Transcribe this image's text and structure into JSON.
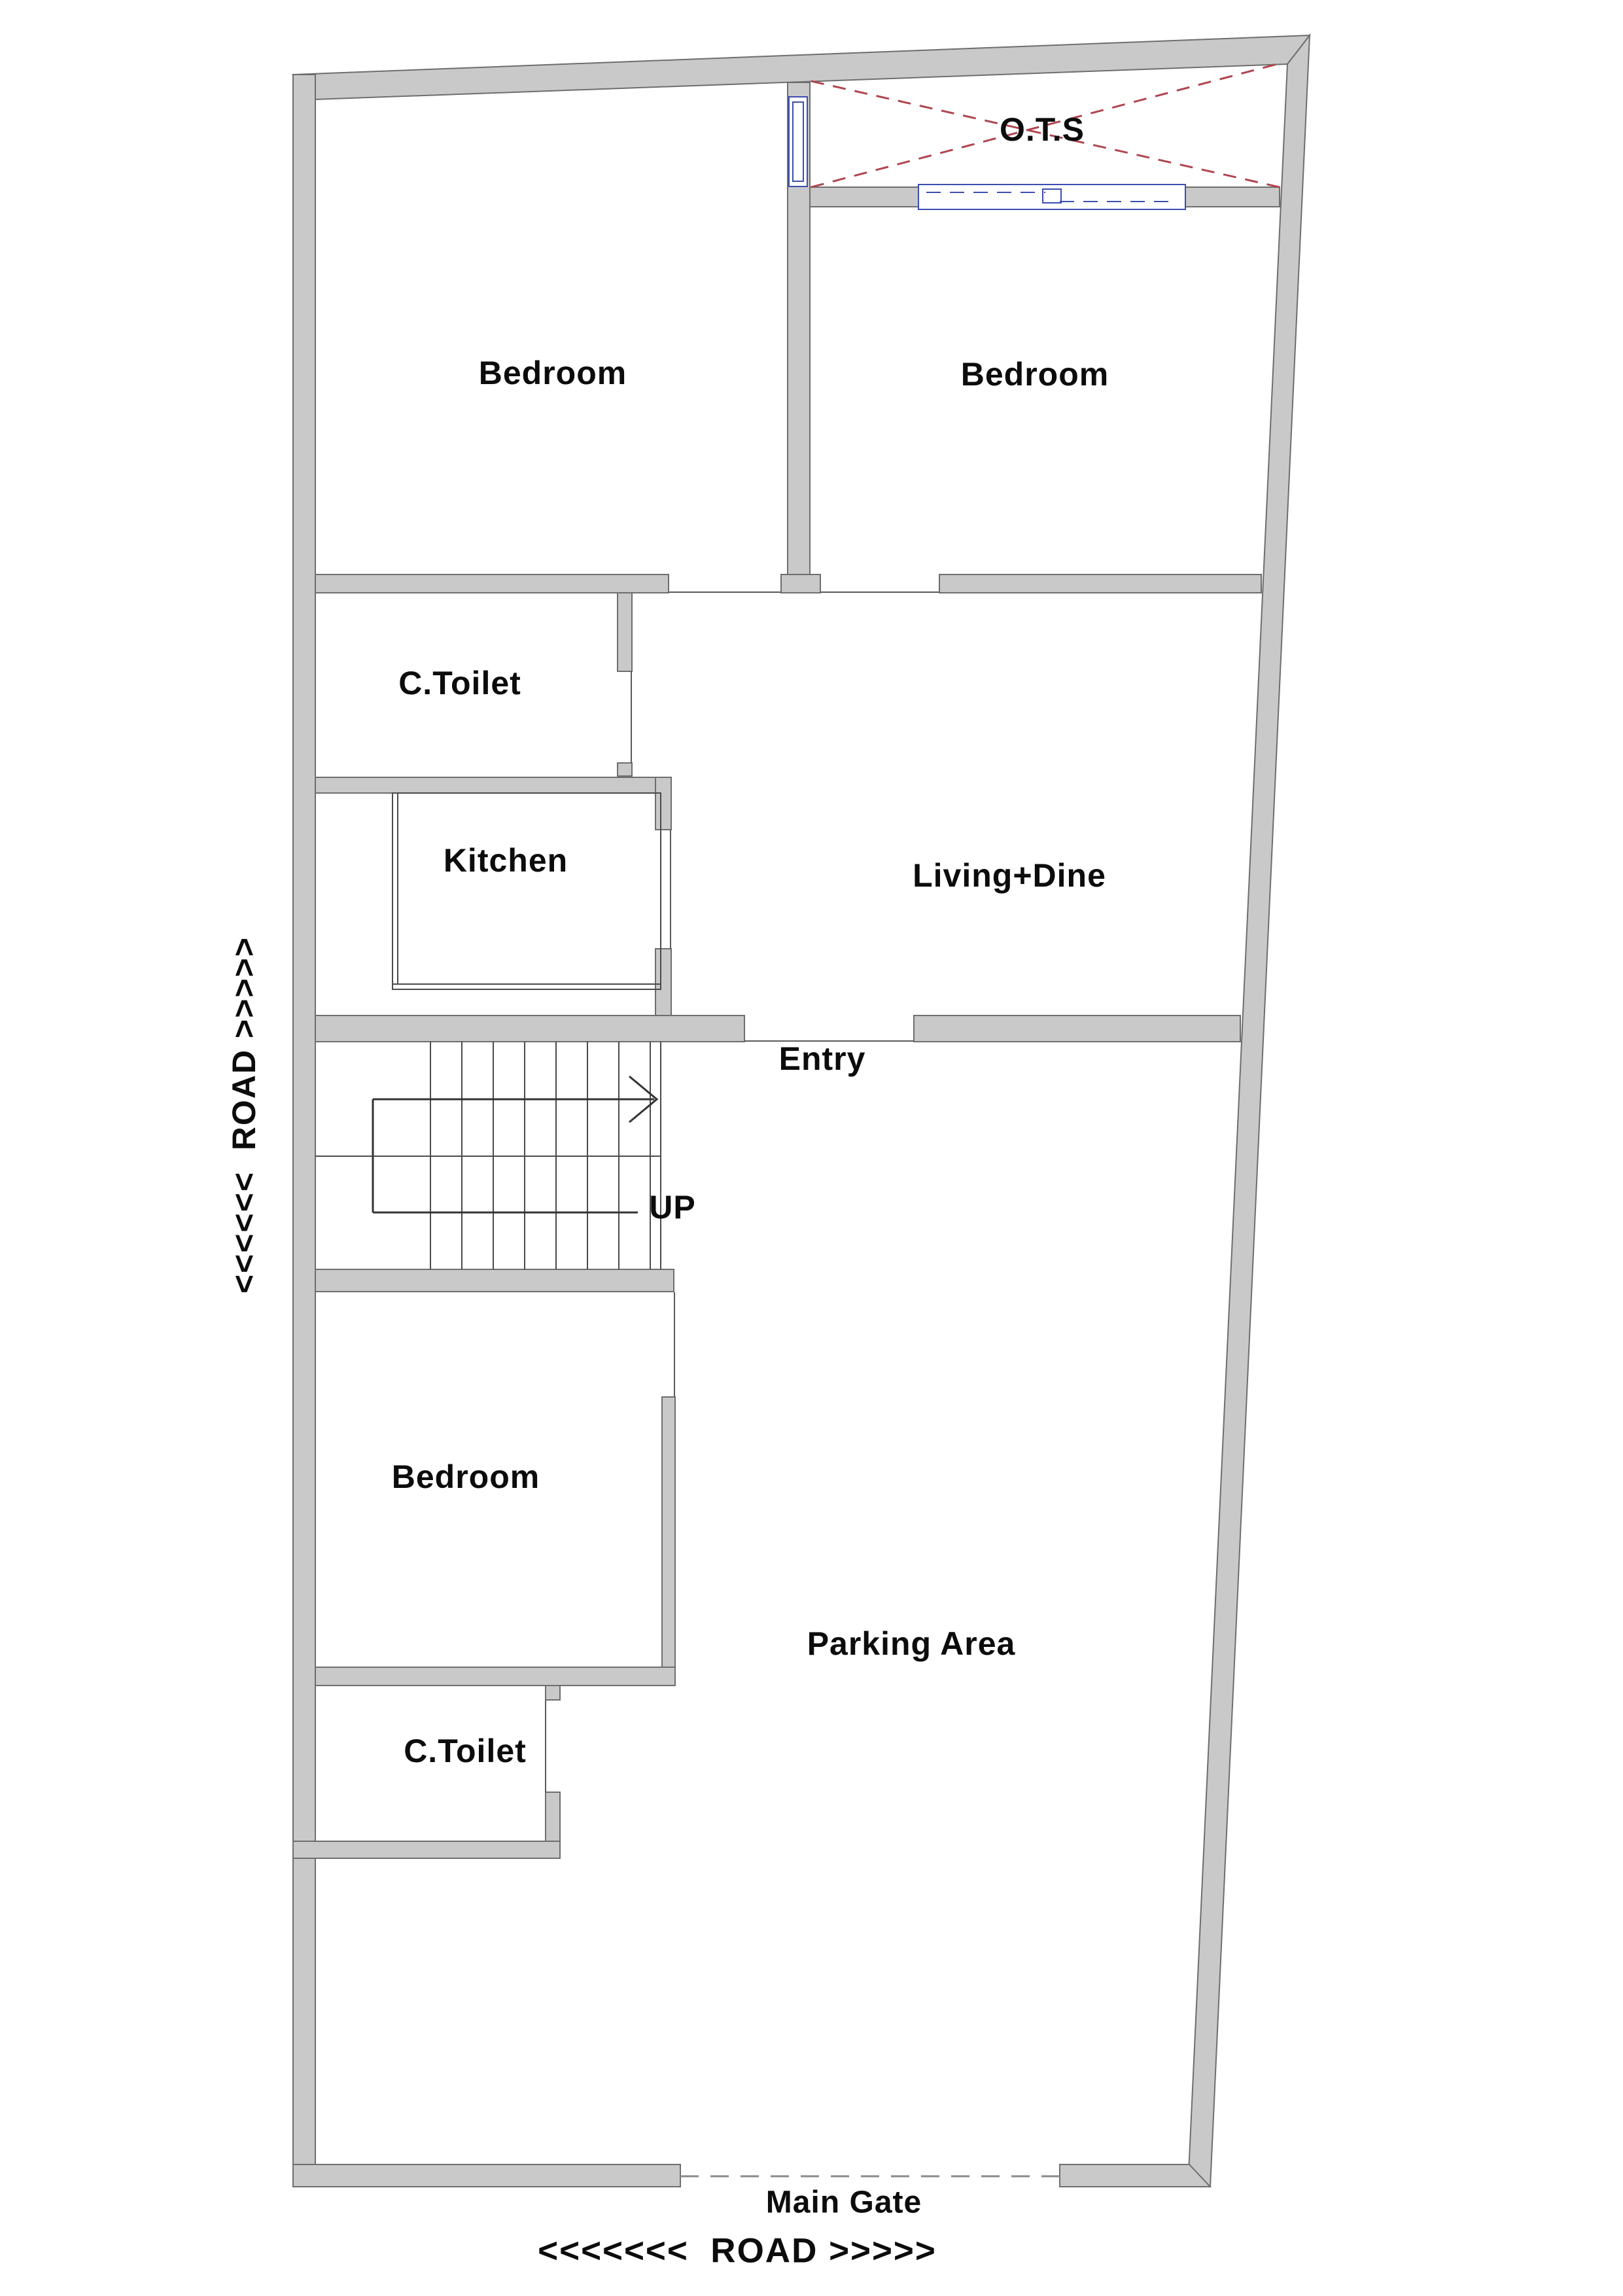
{
  "plan": {
    "labels": {
      "bedroom_top_left": "Bedroom",
      "bedroom_top_right": "Bedroom",
      "bedroom_bottom": "Bedroom",
      "common_toilet_upper": "C.Toilet",
      "common_toilet_lower": "C.Toilet",
      "kitchen": "Kitchen",
      "living_dine": "Living+Dine",
      "entry": "Entry",
      "stairs_up": "UP",
      "ots": "O.T.S",
      "parking": "Parking Area",
      "main_gate": "Main Gate",
      "road_bottom": "<<<<<<<  ROAD >>>>>",
      "road_left": "<<<<<<  ROAD >>>>>"
    }
  },
  "colors": {
    "wall_fill": "#c9c9c9",
    "wall_outline": "#6e6e6e",
    "window_outline": "#3a4db0",
    "ots_cross": "#b0454f",
    "dashed_gate": "#8a8a8a",
    "label_text": "#0c0c0c",
    "background": "#ffffff"
  }
}
